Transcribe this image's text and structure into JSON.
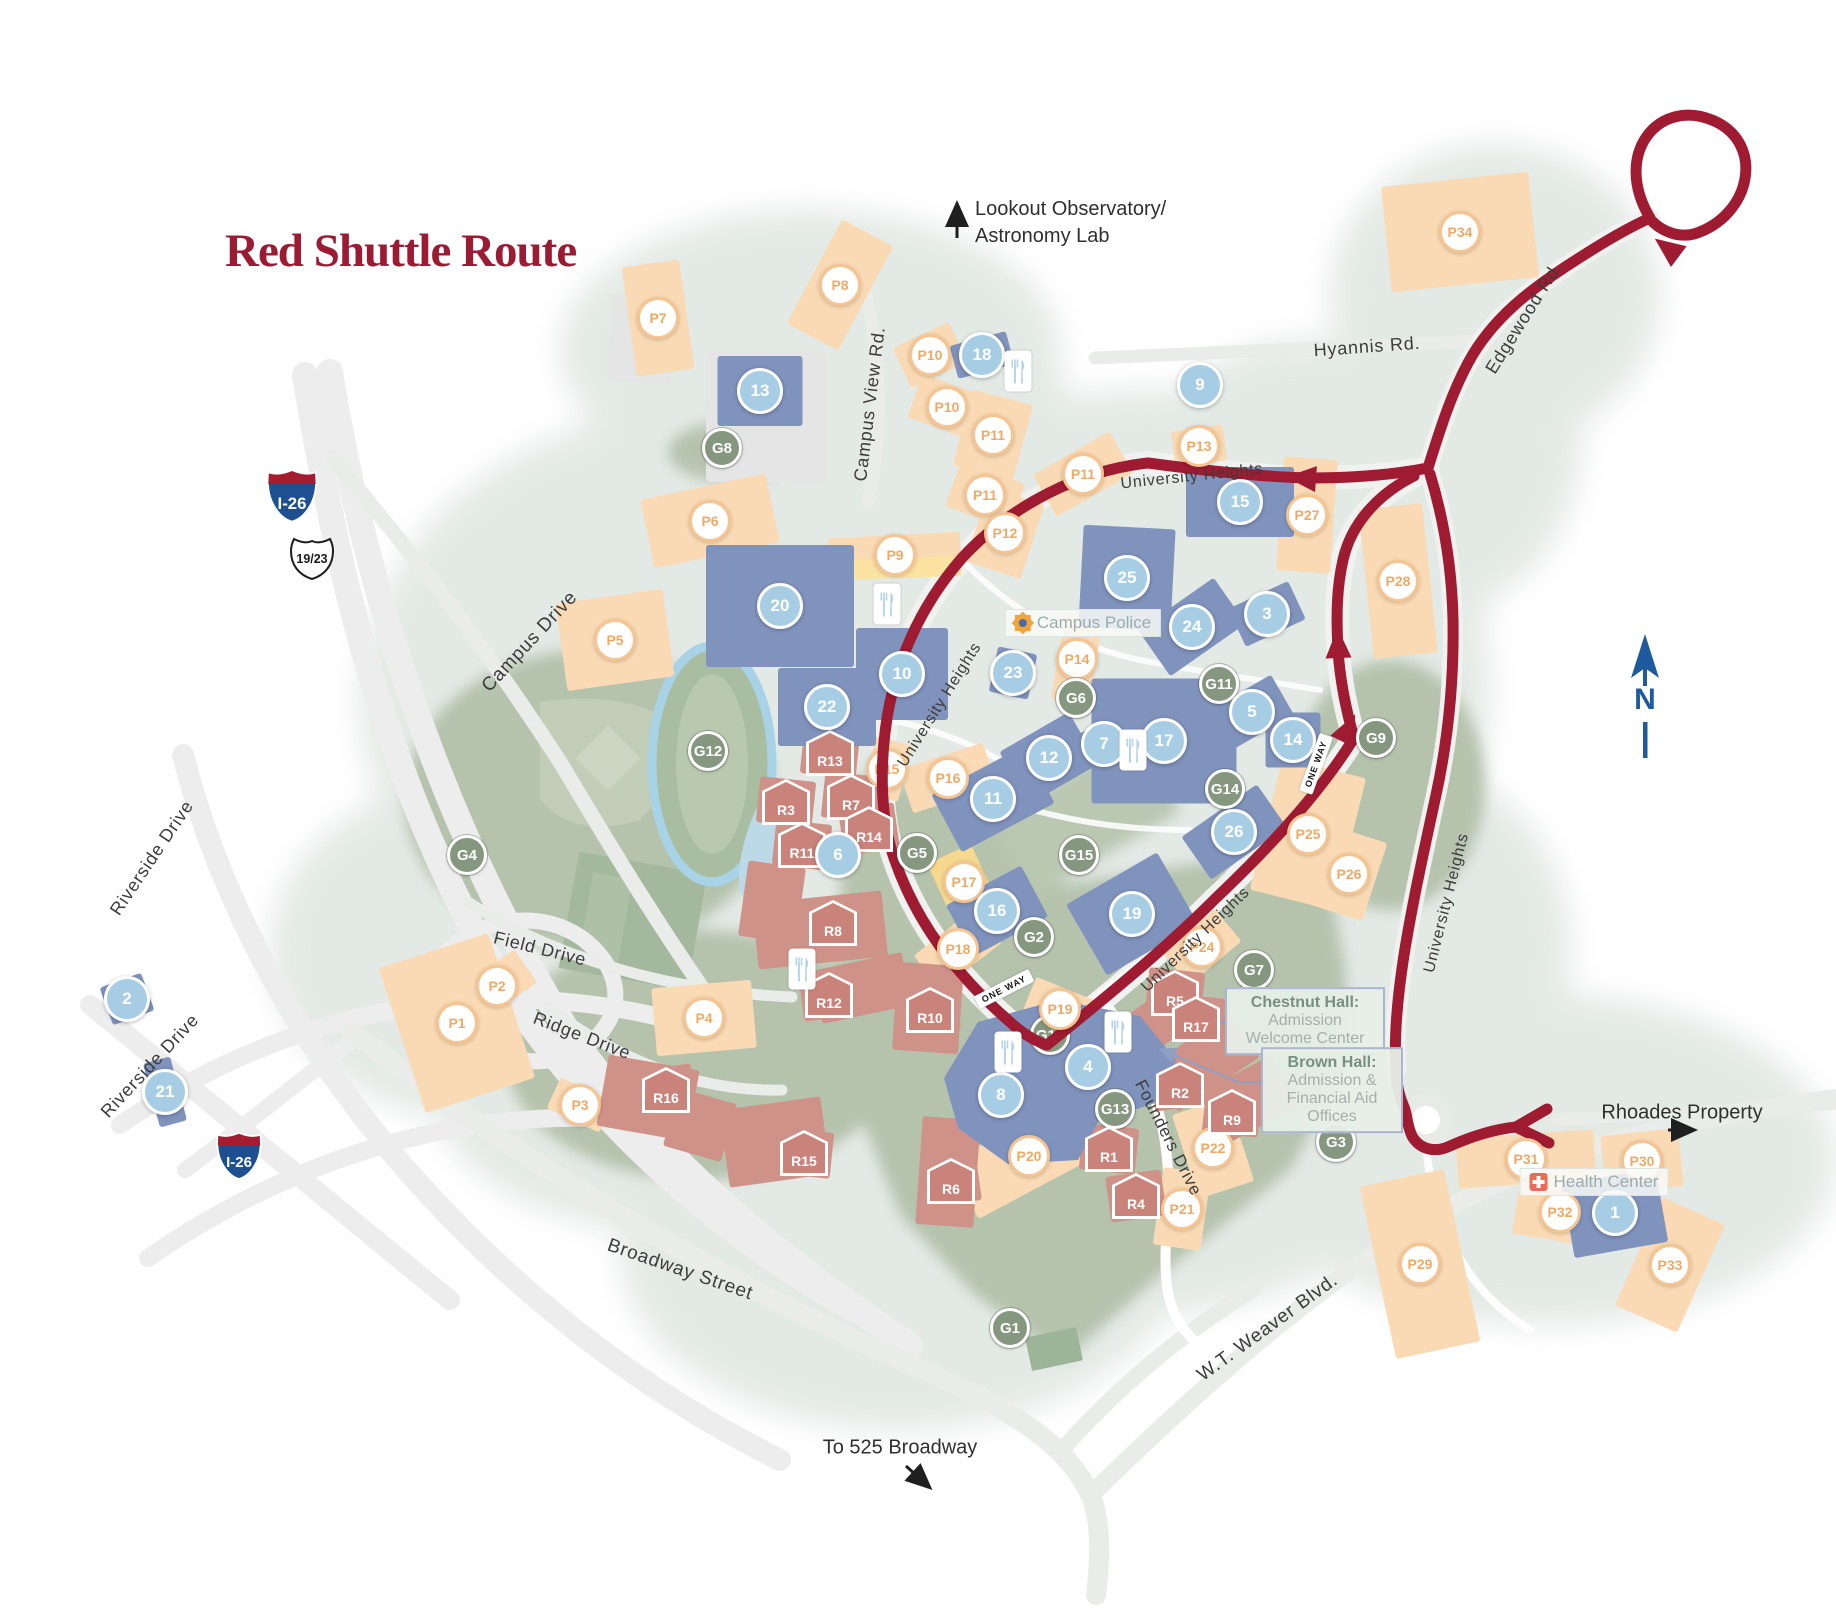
{
  "title": {
    "text": "Red Shuttle Route"
  },
  "colors": {
    "route": "#9e1b32",
    "title": "#9c1b33",
    "stop_fill": "#a7cde4",
    "parking_border": "#f5c491",
    "parking_text": "#f0a964",
    "green_fill": "#85977f",
    "residence_fill": "#c9837a",
    "building_blue": "#8093bd",
    "parking_lot": "#f9dab4",
    "compass_blue": "#1d5b9e",
    "interstate_blue": "#1d4f91",
    "interstate_red": "#a51c30"
  },
  "stops": [
    {
      "label": "1",
      "x": 1615,
      "y": 1213
    },
    {
      "label": "2",
      "x": 127,
      "y": 999
    },
    {
      "label": "3",
      "x": 1267,
      "y": 614
    },
    {
      "label": "4",
      "x": 1088,
      "y": 1067
    },
    {
      "label": "5",
      "x": 1252,
      "y": 712
    },
    {
      "label": "6",
      "x": 838,
      "y": 855
    },
    {
      "label": "7",
      "x": 1104,
      "y": 744
    },
    {
      "label": "8",
      "x": 1001,
      "y": 1095
    },
    {
      "label": "9",
      "x": 1200,
      "y": 385
    },
    {
      "label": "10",
      "x": 902,
      "y": 674
    },
    {
      "label": "11",
      "x": 993,
      "y": 799
    },
    {
      "label": "12",
      "x": 1049,
      "y": 758
    },
    {
      "label": "13",
      "x": 760,
      "y": 391
    },
    {
      "label": "14",
      "x": 1293,
      "y": 740
    },
    {
      "label": "15",
      "x": 1240,
      "y": 502
    },
    {
      "label": "16",
      "x": 997,
      "y": 911
    },
    {
      "label": "17",
      "x": 1164,
      "y": 741
    },
    {
      "label": "18",
      "x": 982,
      "y": 355
    },
    {
      "label": "19",
      "x": 1132,
      "y": 914
    },
    {
      "label": "20",
      "x": 780,
      "y": 606
    },
    {
      "label": "21",
      "x": 165,
      "y": 1092
    },
    {
      "label": "22",
      "x": 827,
      "y": 707
    },
    {
      "label": "23",
      "x": 1013,
      "y": 673
    },
    {
      "label": "24",
      "x": 1192,
      "y": 627
    },
    {
      "label": "25",
      "x": 1127,
      "y": 578
    },
    {
      "label": "26",
      "x": 1234,
      "y": 832
    }
  ],
  "parking": [
    {
      "label": "P1",
      "x": 457,
      "y": 1023
    },
    {
      "label": "P2",
      "x": 497,
      "y": 986
    },
    {
      "label": "P3",
      "x": 580,
      "y": 1105
    },
    {
      "label": "P4",
      "x": 704,
      "y": 1018
    },
    {
      "label": "P5",
      "x": 615,
      "y": 640
    },
    {
      "label": "P6",
      "x": 710,
      "y": 521
    },
    {
      "label": "P7",
      "x": 658,
      "y": 318
    },
    {
      "label": "P8",
      "x": 840,
      "y": 285
    },
    {
      "label": "P9",
      "x": 895,
      "y": 555
    },
    {
      "label": "P10",
      "x": 930,
      "y": 355
    },
    {
      "label": "P10",
      "x": 947,
      "y": 407
    },
    {
      "label": "P11",
      "x": 993,
      "y": 435
    },
    {
      "label": "P11",
      "x": 985,
      "y": 495
    },
    {
      "label": "P11",
      "x": 1083,
      "y": 474
    },
    {
      "label": "P12",
      "x": 1005,
      "y": 533
    },
    {
      "label": "P13",
      "x": 1199,
      "y": 446
    },
    {
      "label": "P14",
      "x": 1077,
      "y": 659
    },
    {
      "label": "P15",
      "x": 887,
      "y": 769,
      "under": true
    },
    {
      "label": "P16",
      "x": 948,
      "y": 778
    },
    {
      "label": "P17",
      "x": 964,
      "y": 882
    },
    {
      "label": "P18",
      "x": 958,
      "y": 949
    },
    {
      "label": "P19",
      "x": 1060,
      "y": 1009
    },
    {
      "label": "P20",
      "x": 1029,
      "y": 1156
    },
    {
      "label": "P21",
      "x": 1182,
      "y": 1209
    },
    {
      "label": "P22",
      "x": 1213,
      "y": 1148
    },
    {
      "label": "P24",
      "x": 1202,
      "y": 947,
      "under": true
    },
    {
      "label": "P25",
      "x": 1308,
      "y": 834
    },
    {
      "label": "P26",
      "x": 1349,
      "y": 874
    },
    {
      "label": "P27",
      "x": 1307,
      "y": 515
    },
    {
      "label": "P28",
      "x": 1398,
      "y": 581
    },
    {
      "label": "P29",
      "x": 1420,
      "y": 1264
    },
    {
      "label": "P30",
      "x": 1642,
      "y": 1161
    },
    {
      "label": "P31",
      "x": 1526,
      "y": 1159
    },
    {
      "label": "P32",
      "x": 1560,
      "y": 1212
    },
    {
      "label": "P33",
      "x": 1670,
      "y": 1265
    },
    {
      "label": "P34",
      "x": 1460,
      "y": 232
    }
  ],
  "green_lots": [
    {
      "label": "G1",
      "x": 1010,
      "y": 1328
    },
    {
      "label": "G2",
      "x": 1034,
      "y": 937
    },
    {
      "label": "G3",
      "x": 1336,
      "y": 1142
    },
    {
      "label": "G4",
      "x": 467,
      "y": 855
    },
    {
      "label": "G5",
      "x": 917,
      "y": 853
    },
    {
      "label": "G6",
      "x": 1076,
      "y": 698
    },
    {
      "label": "G7",
      "x": 1254,
      "y": 970
    },
    {
      "label": "G8",
      "x": 722,
      "y": 448
    },
    {
      "label": "G9",
      "x": 1376,
      "y": 738
    },
    {
      "label": "G10",
      "x": 1050,
      "y": 1035,
      "under": true
    },
    {
      "label": "G11",
      "x": 1219,
      "y": 684
    },
    {
      "label": "G12",
      "x": 708,
      "y": 751
    },
    {
      "label": "G13",
      "x": 1115,
      "y": 1109
    },
    {
      "label": "G14",
      "x": 1225,
      "y": 789
    },
    {
      "label": "G15",
      "x": 1079,
      "y": 855
    }
  ],
  "residences": [
    {
      "label": "R1",
      "x": 1109,
      "y": 1149
    },
    {
      "label": "R2",
      "x": 1180,
      "y": 1085
    },
    {
      "label": "R3",
      "x": 786,
      "y": 802
    },
    {
      "label": "R4",
      "x": 1136,
      "y": 1196
    },
    {
      "label": "R5",
      "x": 1175,
      "y": 993
    },
    {
      "label": "R6",
      "x": 951,
      "y": 1181
    },
    {
      "label": "R7",
      "x": 851,
      "y": 797
    },
    {
      "label": "R8",
      "x": 833,
      "y": 923
    },
    {
      "label": "R9",
      "x": 1232,
      "y": 1112
    },
    {
      "label": "R10",
      "x": 930,
      "y": 1010
    },
    {
      "label": "R11",
      "x": 802,
      "y": 845
    },
    {
      "label": "R12",
      "x": 829,
      "y": 995
    },
    {
      "label": "R13",
      "x": 830,
      "y": 753
    },
    {
      "label": "R14",
      "x": 869,
      "y": 829
    },
    {
      "label": "R15",
      "x": 804,
      "y": 1153
    },
    {
      "label": "R16",
      "x": 666,
      "y": 1090
    },
    {
      "label": "R17",
      "x": 1196,
      "y": 1019
    }
  ],
  "streets": [
    {
      "text": "Campus Drive",
      "x": 530,
      "y": 642,
      "rot": -47,
      "size": 19
    },
    {
      "text": "Campus View Rd.",
      "x": 870,
      "y": 404,
      "rot": -83,
      "size": 18
    },
    {
      "text": "University Heights",
      "x": 1192,
      "y": 477,
      "rot": -6,
      "size": 16
    },
    {
      "text": "University Heights",
      "x": 940,
      "y": 705,
      "rot": -58,
      "size": 16
    },
    {
      "text": "University Heights",
      "x": 1447,
      "y": 903,
      "rot": -76,
      "size": 16
    },
    {
      "text": "University Heights",
      "x": 1196,
      "y": 940,
      "rot": -44,
      "size": 16
    },
    {
      "text": "Hyannis Rd.",
      "x": 1367,
      "y": 347,
      "rot": -4,
      "size": 18
    },
    {
      "text": "Edgewood Rd.",
      "x": 1524,
      "y": 318,
      "rot": -58,
      "size": 18
    },
    {
      "text": "Riverside Drive",
      "x": 152,
      "y": 858,
      "rot": -56,
      "size": 18
    },
    {
      "text": "Riverside Drive",
      "x": 150,
      "y": 1066,
      "rot": -47,
      "size": 18
    },
    {
      "text": "Field Drive",
      "x": 540,
      "y": 949,
      "rot": 14,
      "size": 18
    },
    {
      "text": "Ridge Drive",
      "x": 582,
      "y": 1036,
      "rot": 21,
      "size": 18
    },
    {
      "text": "Broadway Street",
      "x": 680,
      "y": 1270,
      "rot": 19,
      "size": 19
    },
    {
      "text": "Founders Drive",
      "x": 1168,
      "y": 1138,
      "rot": 63,
      "size": 17
    },
    {
      "text": "W.T. Weaver Blvd.",
      "x": 1268,
      "y": 1328,
      "rot": -36,
      "size": 19
    }
  ],
  "one_way": {
    "text": "ONE WAY",
    "items": [
      {
        "x": 1004,
        "y": 989,
        "rot": -27
      },
      {
        "x": 1316,
        "y": 764,
        "rot": -70
      }
    ]
  },
  "poi": {
    "campus_police": {
      "text": "Campus Police",
      "x": 1083,
      "y": 623
    },
    "health_center": {
      "text": "Health Center",
      "x": 1594,
      "y": 1182
    }
  },
  "callouts": [
    {
      "lines": [
        "Chestnut Hall:",
        "Admission",
        "Welcome Center"
      ],
      "x": 1305,
      "y": 1021,
      "w": 138
    },
    {
      "lines": [
        "Brown Hall:",
        "Admission &",
        "Financial Aid",
        "Offices"
      ],
      "x": 1332,
      "y": 1090,
      "w": 120
    }
  ],
  "notes": {
    "lookout": {
      "lines": [
        "Lookout Observatory/",
        "Astronomy Lab"
      ]
    },
    "to525": {
      "text": "To 525 Broadway"
    },
    "rhoades": {
      "text": "Rhoades Property"
    }
  },
  "shields": {
    "items": [
      {
        "type": "interstate",
        "text": "I-26",
        "x": 292,
        "y": 496,
        "s": 56
      },
      {
        "type": "us",
        "text": "19/23",
        "x": 312,
        "y": 557,
        "s": 48
      },
      {
        "type": "interstate",
        "text": "I-26",
        "x": 239,
        "y": 1156,
        "s": 50
      }
    ]
  },
  "compass": {
    "label": "N"
  }
}
